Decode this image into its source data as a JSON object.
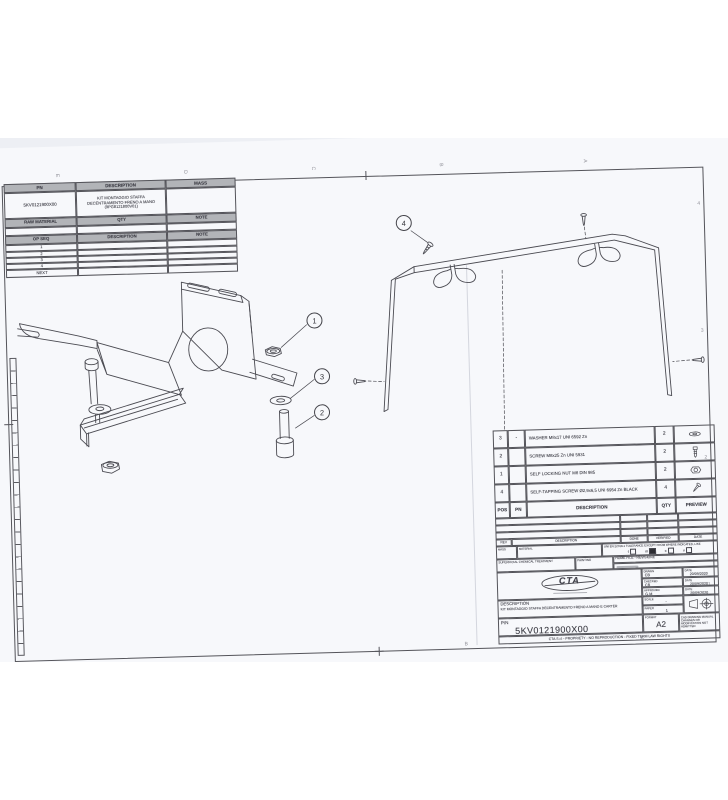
{
  "process_table": {
    "col_pn": "PN",
    "col_description": "DESCRIPTION",
    "col_mass": "MASS",
    "part_number": "5KV0121900X00",
    "part_description": "KIT MONTAGGIO STAFFA DECENTRAMENTO FRENO A MANO (9PG8121800V01)",
    "mass_value": "",
    "raw_material_label": "RAW MATERIAL",
    "qty_label": "QTY",
    "note_label": "NOTE",
    "op_seq_label": "OP SEQ",
    "op_description_label": "DESCRIPTION",
    "op_note_label": "NOTE",
    "op_rows": [
      "1",
      "2",
      "3",
      "4",
      "NEXT"
    ]
  },
  "bom": {
    "header": {
      "pos": "POS",
      "pn": "PN",
      "description": "DESCRIPTION",
      "qty": "QTY",
      "preview": "PREVIEW"
    },
    "rows": [
      {
        "pos": "3",
        "pn": "-",
        "description": "WASHER M8x17 UNI 6592 Zn",
        "qty": "2",
        "preview_icon": "washer-icon"
      },
      {
        "pos": "2",
        "pn": "",
        "description": "SCREW M8x25 Zn UNI 5931",
        "qty": "2",
        "preview_icon": "screw-icon"
      },
      {
        "pos": "1",
        "pn": "",
        "description": "SELF LOCKING NUT M8 DIN 985",
        "qty": "2",
        "preview_icon": "nut-icon"
      },
      {
        "pos": "4",
        "pn": "",
        "description": "SELF-TAPPING SCREW Ø2,9x6,5  UNI 6954 Zn BLACK",
        "qty": "4",
        "preview_icon": "tapping-screw-icon"
      }
    ]
  },
  "title_block": {
    "rev_label": "REV",
    "description_col_label": "DESCRIPTION",
    "done_label": "DONE",
    "verified_label": "VERIFIED",
    "date_col_label": "DATE",
    "mass_label": "MASS",
    "material_label": "MATERIAL",
    "tolerance_note": "UNI EN 22768-1 TOLERANCE EXCEPT FROM WHERE INDICATED, LIKE",
    "tol_f": "f",
    "tol_m": "m",
    "tol_c": "c",
    "tol_v": "v",
    "superficial_label": "SUPERFICIAL CHEMICAL TREATMENT",
    "painting_label": "PAINTING",
    "home_file": "HOME FILE - REVISIONE",
    "logo_text": "CTA",
    "drawn_label": "DRAWN",
    "drawn_value": "CB",
    "drawn_date": "20/09/2020",
    "checked_label": "CHECKED",
    "checked_value": "CB",
    "checked_date": "20/09/2020",
    "approved_label": "APPROVED",
    "approved_value": "G.M",
    "approved_date": "20/09/2020",
    "date_label": "DATE",
    "scale_label": "SCALE",
    "scale_value": "-",
    "paper_label": "PAPER",
    "paper_value": "1",
    "description_label": "DESCRIPTION",
    "description_value": "KIT MONTAGGIO STAFFA DECENTRAMENTO FRENO A MANO E CARTER",
    "pn_label": "P/N",
    "pn_value": "5KV0121900X00",
    "format_label": "FORMAT",
    "format_value": "A2",
    "cad_note": "CAD DRAWING MANUAL CHANGES OR MODIFICATION NOT ADMITTED",
    "footer": "CTA S.r.l - PROPRIETY - NO REPRODUCTION - FIXED TERM LAW RIGHTS"
  },
  "balloons": {
    "b1": "1",
    "b2": "2",
    "b3": "3",
    "b4": "4"
  },
  "zones": {
    "top": [
      "E",
      "D",
      "C",
      "B",
      "A"
    ],
    "right": [
      "4",
      "3",
      "2",
      "1"
    ],
    "bottom": [
      "B",
      "A"
    ]
  },
  "colors": {
    "line": "#4b4b52",
    "paper": "#f7f8fb",
    "photo_bg": "#edeff4",
    "header_gray": "#b2b4b8"
  }
}
